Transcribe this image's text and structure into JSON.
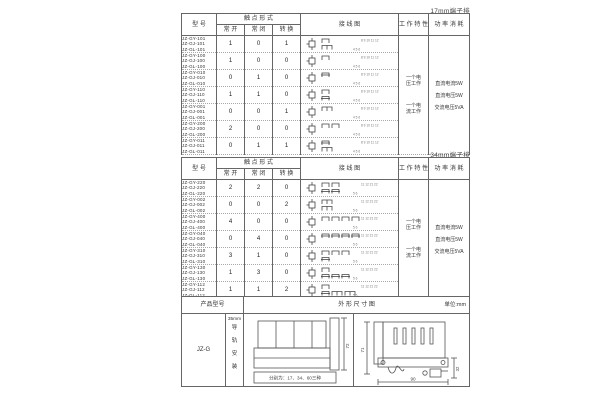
{
  "page": {
    "bg": "#ffffff",
    "line_color": "#666666",
    "text_color": "#333333"
  },
  "table17": {
    "label": "17mm端子排",
    "headers": {
      "model": "型 号",
      "contact_form": "触 点 形 式",
      "no": "常 开",
      "nc": "常 闭",
      "co": "转 换",
      "diagram": "接 线 图",
      "characteristics": "工 作 特 性",
      "power": "功 率 消 耗"
    },
    "characteristics": {
      "line1": "一个电",
      "line2": "压工作",
      "line3": "一个电",
      "line4": "流工作"
    },
    "power": {
      "line1": "直流电流5W",
      "line2": "直流电压5W",
      "line3": "交流电压5VA"
    },
    "diagram_terminals": {
      "top": "8 9 10 11 12",
      "bottom": "4 5 6"
    },
    "rows": [
      {
        "models": [
          "JZ-GY-101",
          "JZ-GJ-101",
          "JZ-GL-101"
        ],
        "no": "1",
        "nc": "0",
        "co": "1"
      },
      {
        "models": [
          "JZ-GY-100",
          "JZ-GJ-100",
          "JZ-GL-100"
        ],
        "no": "1",
        "nc": "0",
        "co": "0"
      },
      {
        "models": [
          "JZ-GY-010",
          "JZ-GJ-010",
          "JZ-GL-010"
        ],
        "no": "0",
        "nc": "1",
        "co": "0"
      },
      {
        "models": [
          "JZ-GY-110",
          "JZ-GJ-110",
          "JZ-GL-110"
        ],
        "no": "1",
        "nc": "1",
        "co": "0"
      },
      {
        "models": [
          "JZ-GY-001",
          "JZ-GJ-001",
          "JZ-GL-001"
        ],
        "no": "0",
        "nc": "0",
        "co": "1"
      },
      {
        "models": [
          "JZ-GY-200",
          "JZ-GJ-200",
          "JZ-GL-200"
        ],
        "no": "2",
        "nc": "0",
        "co": "0"
      },
      {
        "models": [
          "JZ-GY-011",
          "JZ-GJ-011",
          "JZ-GL-011"
        ],
        "no": "0",
        "nc": "1",
        "co": "1"
      }
    ]
  },
  "table34": {
    "label": "34mm端子排",
    "headers": {
      "model": "型 号",
      "contact_form": "触 点 形 式",
      "no": "常 开",
      "nc": "常 闭",
      "co": "转 换",
      "diagram": "接 线 图",
      "characteristics": "工 作 特 性",
      "power": "功 率 消 耗"
    },
    "characteristics": {
      "line1": "一个电",
      "line2": "压工作",
      "line3": "一个电",
      "line4": "流工作"
    },
    "power": {
      "line1": "直流电流5W",
      "line2": "直流电压5W",
      "line3": "交流电压5VA"
    },
    "diagram_terminals": {
      "top": "11 12 21 22",
      "bottom": "5 6"
    },
    "rows": [
      {
        "models": [
          "JZ-GY-220",
          "JZ-GJ-220",
          "JZ-GL-220"
        ],
        "no": "2",
        "nc": "2",
        "co": "0"
      },
      {
        "models": [
          "JZ-GY-002",
          "JZ-GJ-002",
          "JZ-GL-002"
        ],
        "no": "0",
        "nc": "0",
        "co": "2"
      },
      {
        "models": [
          "JZ-GY-400",
          "JZ-GJ-400",
          "JZ-GL-400"
        ],
        "no": "4",
        "nc": "0",
        "co": "0"
      },
      {
        "models": [
          "JZ-GY-040",
          "JZ-GJ-040",
          "JZ-GL-040"
        ],
        "no": "0",
        "nc": "4",
        "co": "0"
      },
      {
        "models": [
          "JZ-GY-310",
          "JZ-GJ-310",
          "JZ-GL-310"
        ],
        "no": "3",
        "nc": "1",
        "co": "0"
      },
      {
        "models": [
          "JZ-GY-130",
          "JZ-GJ-130",
          "JZ-GL-130"
        ],
        "no": "1",
        "nc": "3",
        "co": "0"
      },
      {
        "models": [
          "JZ-GY-112",
          "JZ-GJ-112",
          "JZ-GL-112"
        ],
        "no": "1",
        "nc": "1",
        "co": "2"
      }
    ]
  },
  "bottom": {
    "headers": {
      "product_model": "产品型号",
      "outline": "外 形 尺 寸 图",
      "unit": "单位:mm"
    },
    "product_model": "JZ-G",
    "mounting": {
      "size": "35mm",
      "chars": [
        "导",
        "轨",
        "安",
        "装"
      ]
    },
    "front_view": {
      "height_dim": "72",
      "caption": "分别为：17、34、60三种"
    },
    "side_view": {
      "height_dim": "71",
      "clip_dim": "32",
      "width_dim": "90"
    }
  }
}
